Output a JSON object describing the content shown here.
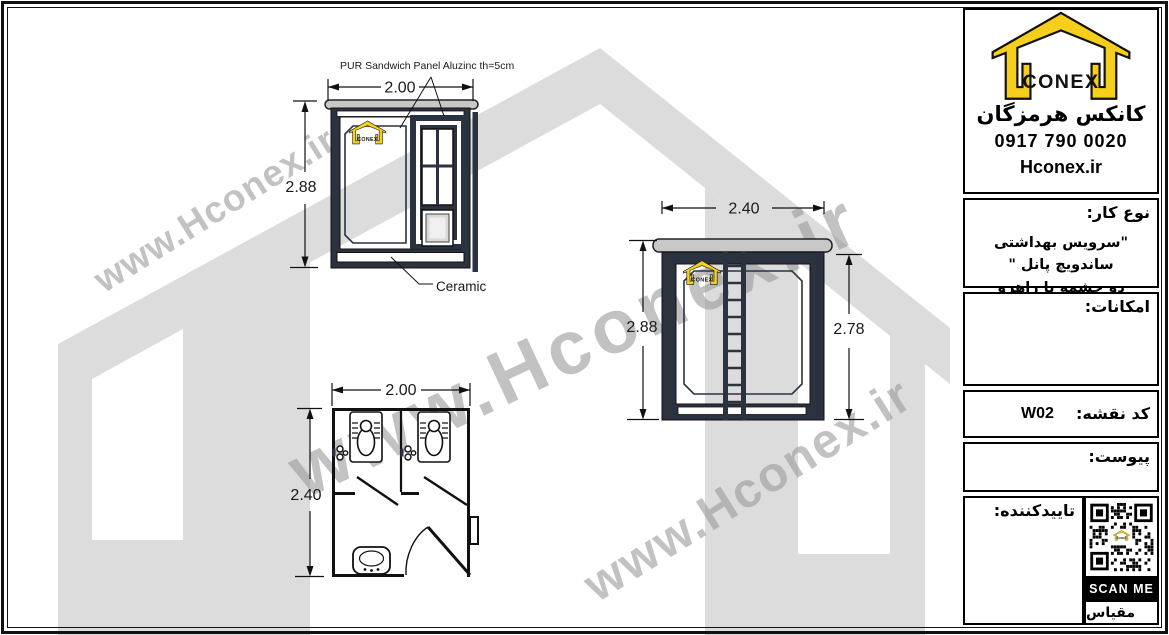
{
  "colors": {
    "frame_dark": "#2b3240",
    "roof_cap": "#c8c8c8",
    "background_house": "#dcdcdc",
    "logo_yellow": "#f5cf1b",
    "watermark_gray": "#9a9a9a"
  },
  "logo": {
    "brand": "CONEX",
    "company_fa": "کانکس هرمزگان",
    "phone": "0917 790 0020",
    "website": "Hconex.ir"
  },
  "watermark": {
    "text": "www.Hconex.ir"
  },
  "title_block": {
    "work_type_label": "نوع کار:",
    "work_type_line1": "\"سرویس بهداشتی ساندویچ پانل \"",
    "work_type_line2": "دو چشمه با راهرو",
    "facilities_label": "امکانات:",
    "map_code_label": "کد نقشه:",
    "map_code_value": "W02",
    "attachment_label": "پیوست:",
    "approver_label": "تاییدکننده:",
    "scan_me_label": "SCAN ME",
    "scale_label": "مقیاس"
  },
  "drawings": {
    "front_elevation": {
      "width_m": "2.00",
      "height_m": "2.88",
      "panel_note": "PUR Sandwich Panel Aluzinc  th=5cm",
      "floor_note": "Ceramic"
    },
    "side_elevation": {
      "width_m": "2.40",
      "height_left_m": "2.88",
      "height_right_m": "2.78"
    },
    "floor_plan": {
      "width_m": "2.00",
      "depth_m": "2.40"
    }
  }
}
